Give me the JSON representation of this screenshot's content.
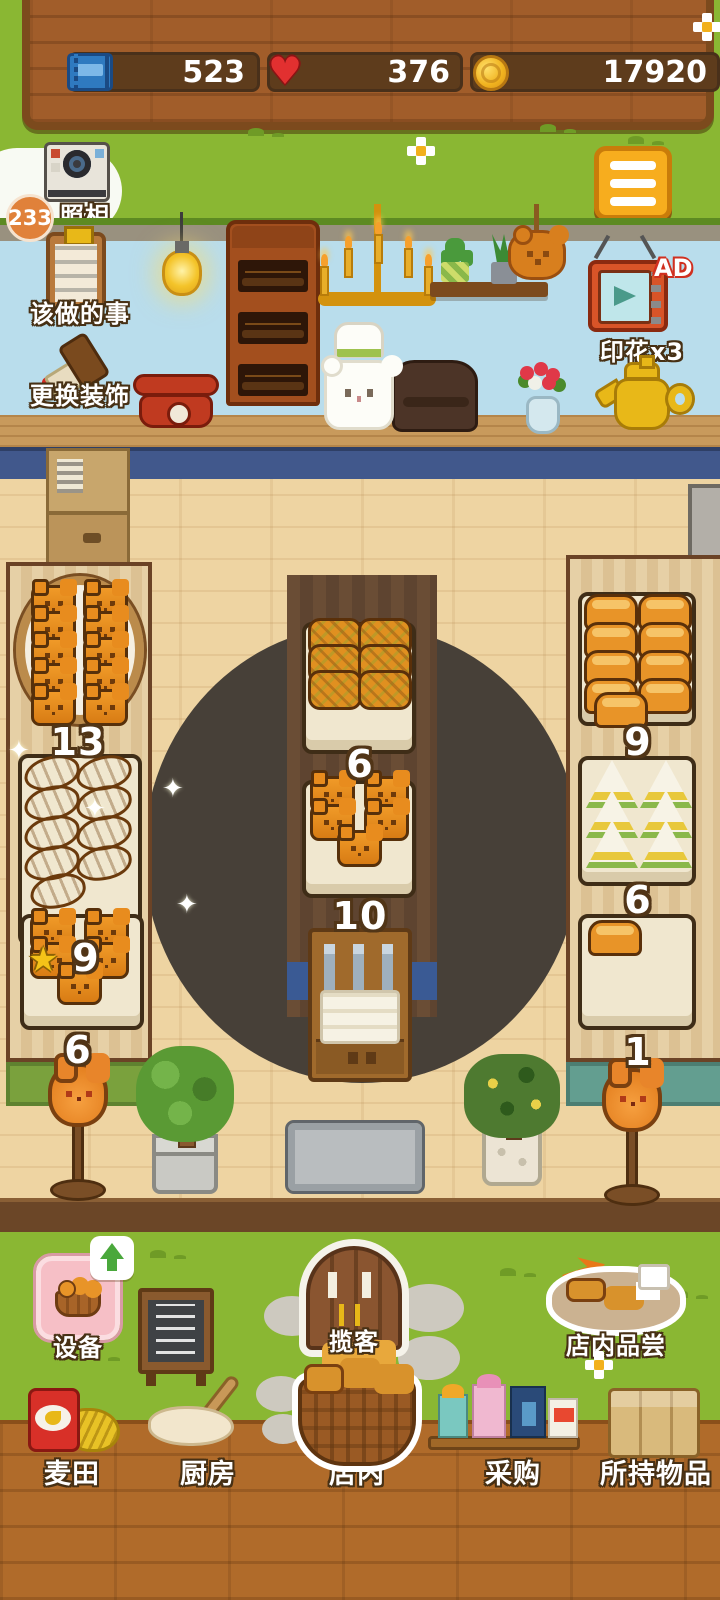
{
  "status_bar": {
    "tickets_value": "523",
    "hearts_value": "376",
    "coins_value": "17920"
  },
  "hud": {
    "camera_count": "233",
    "camera_label": "照相",
    "todo_label": "该做的事",
    "decor_label": "更换装饰",
    "ad_badge": "AD",
    "stamp_reward_label": "印花x3"
  },
  "displays": {
    "left_top_count": "13",
    "left_mid_count": "9",
    "left_bottom_count": "6",
    "center_top_count": "6",
    "center_mid_count": "10",
    "right_top_count": "9",
    "right_mid_count": "6",
    "right_bottom_count": "1"
  },
  "yard_menu": {
    "equipment_label": "设备",
    "attract_label": "揽客",
    "tasting_label": "店内品尝"
  },
  "bottom_nav": {
    "wheat_label": "麦田",
    "kitchen_label": "厨房",
    "store_label": "店内",
    "purchase_label": "采购",
    "inventory_label": "所持物品"
  },
  "icons": {
    "star_glyph": "★",
    "sparkle_glyph": "✦"
  },
  "colors": {
    "grass": "#8ab733",
    "sign_wood": "#a15d2a",
    "stat_pill": "#5e3c1c",
    "wall_sky": "#b9ddec",
    "floor_wood": "#eed4a2",
    "counter_blue": "#41588c",
    "accent_orange": "#f7ad1e",
    "bread_orange": "#e8891c",
    "bottom_wood": "#b06b2a"
  }
}
